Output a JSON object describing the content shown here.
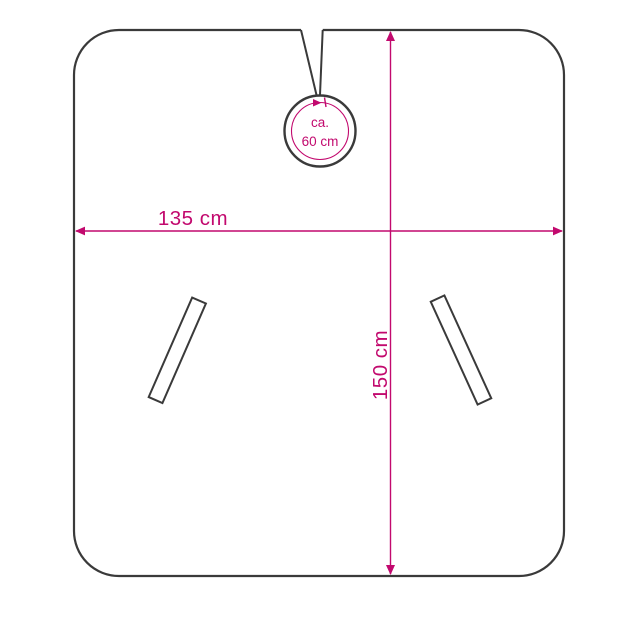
{
  "colors": {
    "accent": "#c2096e",
    "outline": "#3a3a3a",
    "surface": "#ffffff"
  },
  "diagram": {
    "width_label": "135 cm",
    "height_label": "150 cm",
    "neck_label_line1": "ca.",
    "neck_label_line2": "60 cm"
  }
}
